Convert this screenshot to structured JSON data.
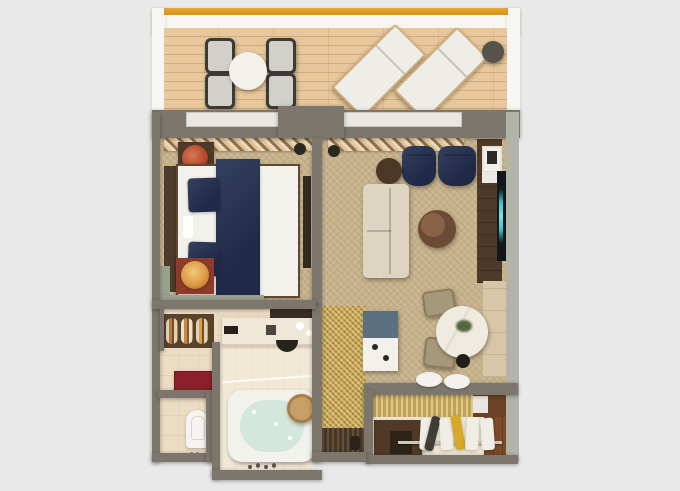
{
  "scene": {
    "kind": "3d-floor-plan-render",
    "view": "top-down",
    "unit": "hotel suite with balcony",
    "rooms": [
      {
        "id": "balcony",
        "name": "Balcony",
        "items": [
          "yellow awning edge",
          "wood deck",
          "round dining table",
          "4 outdoor chairs",
          "2 white sun loungers (diagonal)",
          "dark round side table"
        ]
      },
      {
        "id": "bedroom",
        "name": "Bedroom",
        "items": [
          "king bed white linens",
          "navy bed runner",
          "2 navy pillows",
          "dark wood headboard",
          "nightstand with red lamp",
          "nightstand with orange lamp",
          "wall-mounted TV panel",
          "sage window bench",
          "sheer curtains"
        ]
      },
      {
        "id": "living-room",
        "name": "Living Room",
        "items": [
          "2 navy armchairs",
          "dark brown ottoman",
          "cream sofa",
          "round two-tone coffee table",
          "dark wood TV console",
          "TV with teal glow",
          "framed picture",
          "beige side cabinet",
          "sheer curtains"
        ]
      },
      {
        "id": "dining-nook",
        "name": "Dining Nook",
        "items": [
          "round marble table with plant",
          "2 tan chairs",
          "black stool",
          "minibar cabinet blue top",
          "2 white dome wall lamps"
        ]
      },
      {
        "id": "bathroom",
        "name": "Bathroom",
        "items": [
          "vanity with dark counter",
          "black half-round sink",
          "towel shelf with striped rolls",
          "dark red bench",
          "bathtub with pale water",
          "wooden stool",
          "glass screen"
        ]
      },
      {
        "id": "wc",
        "name": "WC",
        "items": [
          "toilet"
        ]
      },
      {
        "id": "corridor",
        "name": "Entry Corridor",
        "items": [
          "gold carpet",
          "dark door mat",
          "entrance door handle"
        ]
      },
      {
        "id": "closet",
        "name": "Entry Closet",
        "items": [
          "dark luggage bench",
          "closet rod",
          "white garment bags",
          "dark garment",
          "yellow garment",
          "white safe box",
          "wood floor"
        ]
      }
    ]
  },
  "palette": {
    "bg": "#e9e9e9",
    "wall-gray": "#7d766c",
    "wall-sage": "#b2b4a7",
    "white-wall": "#f7f6f3",
    "awning-yellow": "#e9a72b",
    "deck-wood": "#e7c79b",
    "carpet": "#c6b28c",
    "gold": "#c2a254",
    "tile": "#ecdcc4",
    "tile-light": "#f2e8d6",
    "wallpaper-gold": "#bfa258",
    "floor-cream": "#efe6d4",
    "navy": "#202a47",
    "linen-white": "#f3f1ec",
    "wood-dark": "#4e3a28",
    "wood-mid": "#7b4a28",
    "sofa-cream": "#ddd4c2",
    "ottoman-brown": "#4c3727",
    "table-brown": "#6b4b35",
    "table-brown-lt": "#8a6247",
    "tv-black": "#13161a",
    "tv-teal": "#3ec3c6",
    "marble": "#f0ebe1",
    "chair-tan": "#a7977b",
    "minibar-blue": "#5a7080",
    "bench-red": "#8c2029",
    "water": "#d4e7dd",
    "lamp-red": "#b5472f",
    "lamp-orange": "#dd9a45",
    "sage": "#99a08e",
    "garment-yellow": "#d7a92b",
    "garment-dark": "#403c37",
    "mat-brown": "#463626",
    "plant-green": "#55673c"
  }
}
